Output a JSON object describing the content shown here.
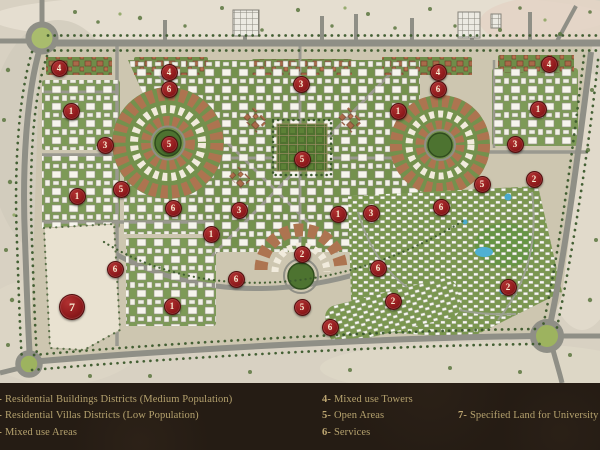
{
  "legend": {
    "background": "#251c14",
    "text_color": "#b5a26e",
    "columns": [
      {
        "items": [
          {
            "num": "1-",
            "label": "Residential Buildings  Districts (Medium Population)"
          },
          {
            "num": "2-",
            "label": "Residential Villas  Districts (Low Population)"
          },
          {
            "num": "3-",
            "label": "Mixed use Areas"
          }
        ]
      },
      {
        "items": [
          {
            "num": "4-",
            "label": "Mixed use Towers"
          },
          {
            "num": "5-",
            "label": "Open Areas"
          },
          {
            "num": "6-",
            "label": "Services"
          }
        ]
      },
      {
        "items": [
          {
            "num": "7-",
            "label": "Specified Land for University"
          }
        ]
      }
    ]
  },
  "map": {
    "marker_color": "#8e1a1c",
    "road_color": "#8f8f86",
    "sand_color": "#d8d1c2",
    "green_color": "#74914d",
    "terracotta_color": "#ad7450",
    "markers": [
      {
        "label": "4",
        "x": 58,
        "y": 67
      },
      {
        "label": "1",
        "x": 70,
        "y": 110
      },
      {
        "label": "3",
        "x": 104,
        "y": 144
      },
      {
        "label": "1",
        "x": 76,
        "y": 195
      },
      {
        "label": "5",
        "x": 120,
        "y": 188
      },
      {
        "label": "6",
        "x": 114,
        "y": 268
      },
      {
        "label": "7",
        "x": 71,
        "y": 306,
        "big": true
      },
      {
        "label": "4",
        "x": 168,
        "y": 71
      },
      {
        "label": "6",
        "x": 168,
        "y": 88
      },
      {
        "label": "5",
        "x": 168,
        "y": 143
      },
      {
        "label": "6",
        "x": 172,
        "y": 207
      },
      {
        "label": "3",
        "x": 238,
        "y": 209
      },
      {
        "label": "1",
        "x": 210,
        "y": 233
      },
      {
        "label": "6",
        "x": 235,
        "y": 278
      },
      {
        "label": "1",
        "x": 171,
        "y": 305
      },
      {
        "label": "3",
        "x": 300,
        "y": 83
      },
      {
        "label": "5",
        "x": 301,
        "y": 158
      },
      {
        "label": "2",
        "x": 301,
        "y": 253
      },
      {
        "label": "5",
        "x": 301,
        "y": 306
      },
      {
        "label": "6",
        "x": 329,
        "y": 326
      },
      {
        "label": "1",
        "x": 337,
        "y": 213
      },
      {
        "label": "3",
        "x": 370,
        "y": 212
      },
      {
        "label": "6",
        "x": 377,
        "y": 267
      },
      {
        "label": "2",
        "x": 392,
        "y": 300
      },
      {
        "label": "1",
        "x": 397,
        "y": 110
      },
      {
        "label": "4",
        "x": 437,
        "y": 71
      },
      {
        "label": "6",
        "x": 437,
        "y": 88
      },
      {
        "label": "6",
        "x": 440,
        "y": 206
      },
      {
        "label": "5",
        "x": 481,
        "y": 183
      },
      {
        "label": "2",
        "x": 507,
        "y": 286
      },
      {
        "label": "4",
        "x": 548,
        "y": 63
      },
      {
        "label": "1",
        "x": 537,
        "y": 108
      },
      {
        "label": "3",
        "x": 514,
        "y": 143
      },
      {
        "label": "2",
        "x": 533,
        "y": 178
      }
    ]
  }
}
